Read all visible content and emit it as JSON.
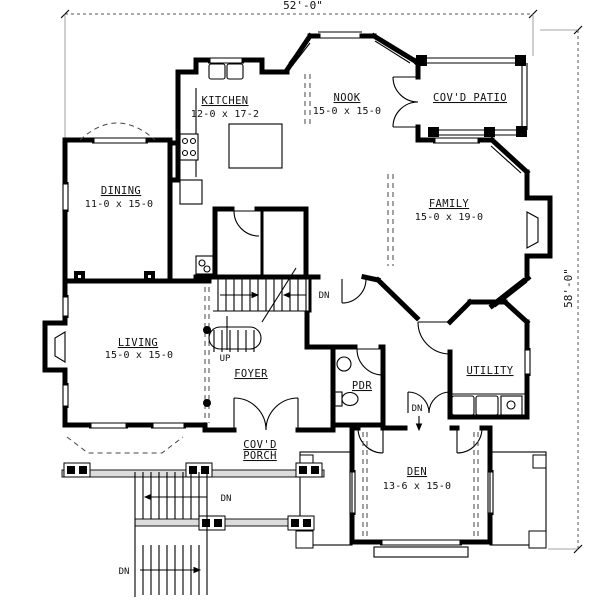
{
  "meta": {
    "drawing_type": "architectural floor plan",
    "floor": "main level"
  },
  "dimensions": {
    "overall_width": "52'-0\"",
    "overall_height": "58'-0\""
  },
  "rooms": {
    "kitchen": {
      "name": "KITCHEN",
      "size": "12-0 x 17-2"
    },
    "nook": {
      "name": "NOOK",
      "size": "15-0 x 15-0"
    },
    "covd_patio": {
      "name": "COV'D PATIO"
    },
    "dining": {
      "name": "DINING",
      "size": "11-0 x 15-0"
    },
    "family": {
      "name": "FAMILY",
      "size": "15-0 x 19-0"
    },
    "living": {
      "name": "LIVING",
      "size": "15-0 x 15-0"
    },
    "foyer": {
      "name": "FOYER"
    },
    "pdr": {
      "name": "PDR"
    },
    "utility": {
      "name": "UTILITY"
    },
    "covd_porch": {
      "name_line1": "COV'D",
      "name_line2": "PORCH"
    },
    "den": {
      "name": "DEN",
      "size": "13-6 x 15-0"
    }
  },
  "stairs": {
    "up_label": "UP",
    "down_label": "DN"
  },
  "colors": {
    "ink": "#000000",
    "paper": "#ffffff",
    "deck_hatch": "#dcdcdc"
  }
}
